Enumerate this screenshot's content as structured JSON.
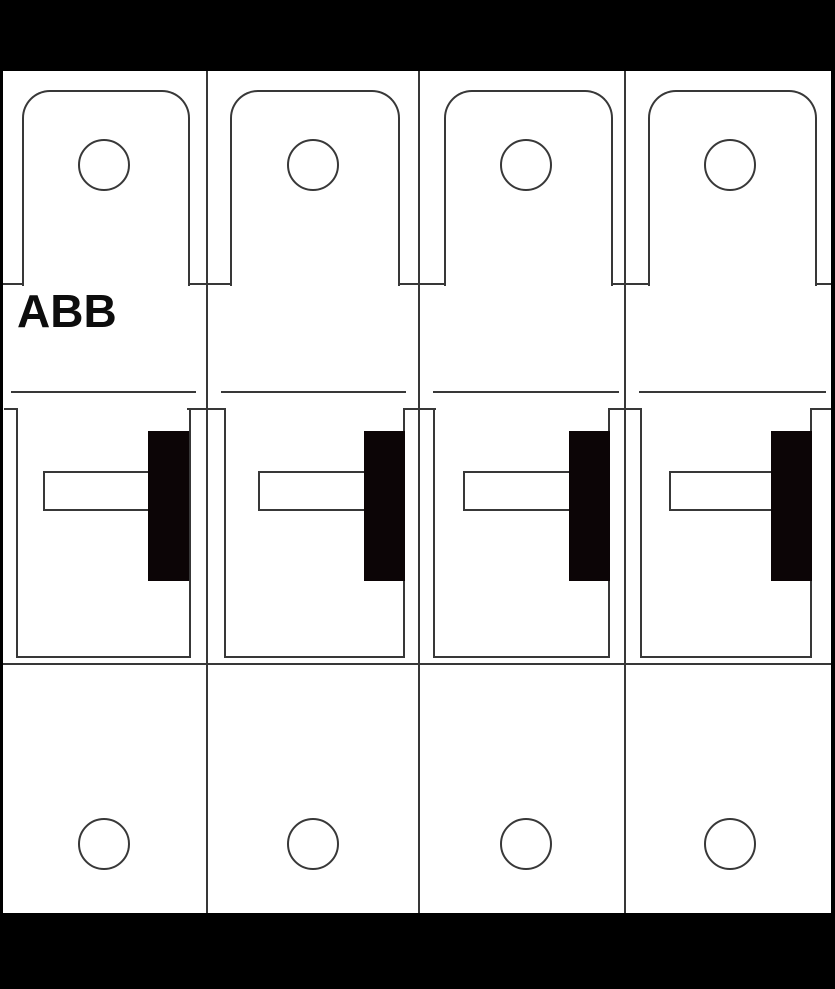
{
  "brand": {
    "label": "ABB"
  },
  "colors": {
    "background": "#000000",
    "device_body": "#ffffff",
    "outline": "#383838",
    "handle_grip": "#0c0506",
    "brand_text": "#0d0d0d"
  },
  "icons": {
    "screw_hole": "circle-outline",
    "switch_handle": "black-grip-with-white-lever"
  },
  "modules": [
    {
      "id": "pole-1"
    },
    {
      "id": "pole-2"
    },
    {
      "id": "pole-3"
    },
    {
      "id": "pole-4"
    }
  ]
}
